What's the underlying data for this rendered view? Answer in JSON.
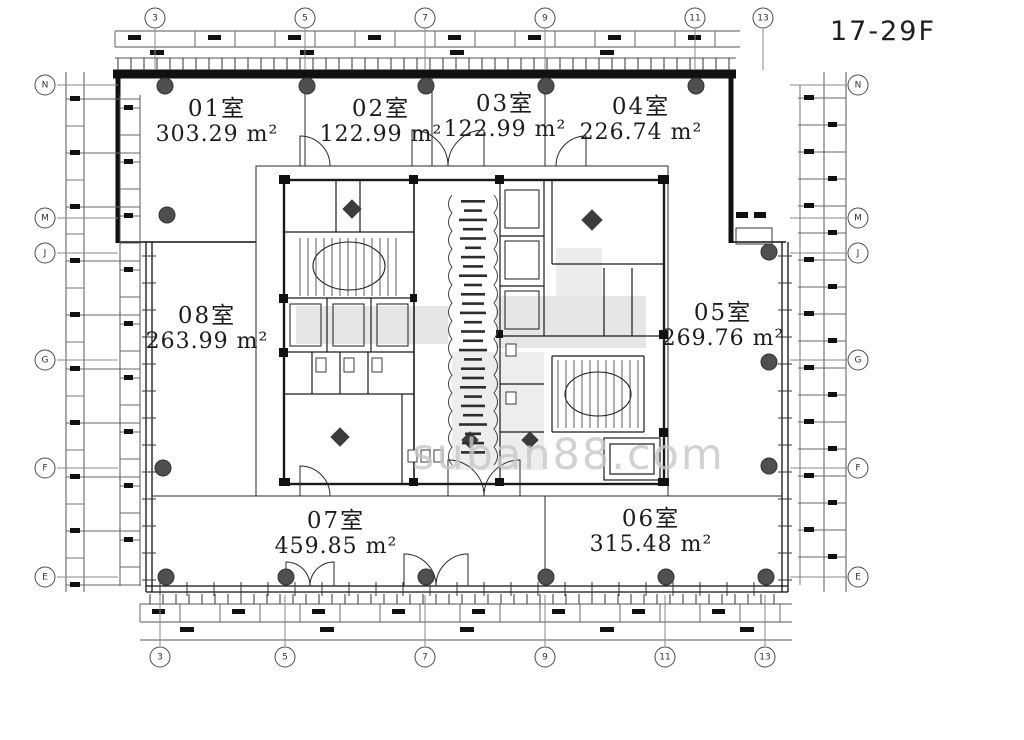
{
  "title": "17-29F",
  "watermark": "suban88.com",
  "rooms": [
    {
      "name": "01室",
      "area": "303.29 m²",
      "cx": 217,
      "cy": 96
    },
    {
      "name": "02室",
      "area": "122.99 m²",
      "cx": 381,
      "cy": 96
    },
    {
      "name": "03室",
      "area": "122.99 m²",
      "cx": 505,
      "cy": 91
    },
    {
      "name": "04室",
      "area": "226.74 m²",
      "cx": 641,
      "cy": 94
    },
    {
      "name": "05室",
      "area": "269.76 m²",
      "cx": 723,
      "cy": 300
    },
    {
      "name": "06室",
      "area": "315.48 m²",
      "cx": 651,
      "cy": 506
    },
    {
      "name": "07室",
      "area": "459.85 m²",
      "cx": 336,
      "cy": 508
    },
    {
      "name": "08室",
      "area": "263.99 m²",
      "cx": 207,
      "cy": 303
    }
  ],
  "grid": {
    "top": {
      "y": 18,
      "items": [
        {
          "label": "3",
          "x": 155
        },
        {
          "label": "5",
          "x": 305
        },
        {
          "label": "7",
          "x": 425
        },
        {
          "label": "9",
          "x": 545
        },
        {
          "label": "11",
          "x": 695
        },
        {
          "label": "13",
          "x": 763
        }
      ]
    },
    "bottom": {
      "y": 657,
      "items": [
        {
          "label": "3",
          "x": 160
        },
        {
          "label": "5",
          "x": 285
        },
        {
          "label": "7",
          "x": 425
        },
        {
          "label": "9",
          "x": 545
        },
        {
          "label": "11",
          "x": 665
        },
        {
          "label": "13",
          "x": 765
        }
      ]
    },
    "left": {
      "x": 45,
      "items": [
        {
          "label": "N",
          "y": 85
        },
        {
          "label": "M",
          "y": 218
        },
        {
          "label": "J",
          "y": 253
        },
        {
          "label": "G",
          "y": 360
        },
        {
          "label": "F",
          "y": 468
        },
        {
          "label": "E",
          "y": 577
        }
      ]
    },
    "right": {
      "x": 858,
      "items": [
        {
          "label": "N",
          "y": 85
        },
        {
          "label": "M",
          "y": 218
        },
        {
          "label": "J",
          "y": 253
        },
        {
          "label": "G",
          "y": 360
        },
        {
          "label": "F",
          "y": 468
        },
        {
          "label": "E",
          "y": 577
        }
      ]
    }
  },
  "columns": [
    [
      165,
      86
    ],
    [
      307,
      86
    ],
    [
      426,
      86
    ],
    [
      546,
      86
    ],
    [
      696,
      86
    ],
    [
      167,
      215
    ],
    [
      163,
      468
    ],
    [
      769,
      252
    ],
    [
      769,
      362
    ],
    [
      769,
      466
    ],
    [
      166,
      577
    ],
    [
      286,
      577
    ],
    [
      426,
      577
    ],
    [
      546,
      577
    ],
    [
      666,
      577
    ],
    [
      766,
      577
    ]
  ],
  "colors": {
    "line": "#1a1a1a",
    "column": "#4f4f4f",
    "corridor": "#d9d9d9",
    "watermark": "#c7c7c7"
  }
}
